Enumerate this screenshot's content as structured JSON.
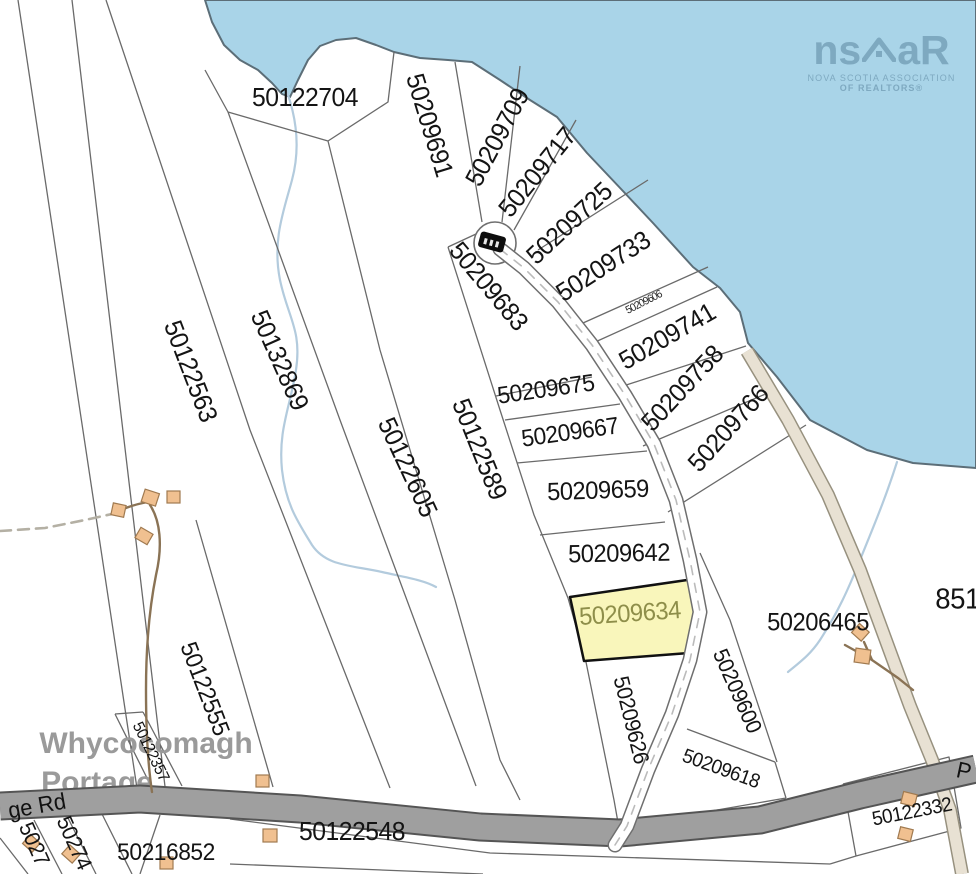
{
  "title": "Whycocomagh Portage parcel map",
  "logo": {
    "left": "ns",
    "right": "aR",
    "tagline1": "NOVA SCOTIA ASSOCIATION",
    "tagline2": "OF REALTORS®"
  },
  "place": {
    "line1": "Whycocomagh",
    "line2": "Portage"
  },
  "highlighted_parcel": {
    "id": "50209634"
  },
  "colors": {
    "water": "#a9d4e8",
    "shoreline": "#5c6e78",
    "parcel_line": "#6a6a6a",
    "highlight_fill": "#f9f6bb",
    "highlight_stroke": "#111111",
    "highlight_label": "#8e8e4a",
    "road_major_fill": "#9f9f9f",
    "road_minor_fill": "#ffffff",
    "highway_fill": "#e8e1d3",
    "building_fill": "#f0c090",
    "stream": "#b3cbdd",
    "logo_color": "#7ea9c0",
    "place_color": "#9a9a9a"
  },
  "labels": [
    {
      "text": "50122704",
      "x": 305,
      "y": 97,
      "rot": 0,
      "size": 26
    },
    {
      "text": "50209691",
      "x": 430,
      "y": 125,
      "rot": 73,
      "size": 26
    },
    {
      "text": "50209709",
      "x": 497,
      "y": 137,
      "rot": -62,
      "size": 26
    },
    {
      "text": "50209717",
      "x": 537,
      "y": 172,
      "rot": -51,
      "size": 26
    },
    {
      "text": "50209725",
      "x": 569,
      "y": 223,
      "rot": -43,
      "size": 26
    },
    {
      "text": "50209733",
      "x": 603,
      "y": 266,
      "rot": -33,
      "size": 26
    },
    {
      "text": "50209606",
      "x": 644,
      "y": 303,
      "rot": -27,
      "size": 11,
      "kind": "tiny"
    },
    {
      "text": "50209741",
      "x": 667,
      "y": 336,
      "rot": -30,
      "size": 26
    },
    {
      "text": "50209758",
      "x": 682,
      "y": 388,
      "rot": -47,
      "size": 26
    },
    {
      "text": "50209766",
      "x": 728,
      "y": 428,
      "rot": -48,
      "size": 26
    },
    {
      "text": "50209683",
      "x": 489,
      "y": 286,
      "rot": 50,
      "size": 26
    },
    {
      "text": "50122563",
      "x": 191,
      "y": 371,
      "rot": 69,
      "size": 26
    },
    {
      "text": "50132869",
      "x": 280,
      "y": 360,
      "rot": 66,
      "size": 26
    },
    {
      "text": "50122605",
      "x": 408,
      "y": 467,
      "rot": 65,
      "size": 26
    },
    {
      "text": "50122589",
      "x": 480,
      "y": 449,
      "rot": 68,
      "size": 26
    },
    {
      "text": "50209675",
      "x": 546,
      "y": 390,
      "rot": -8,
      "size": 24
    },
    {
      "text": "50209667",
      "x": 570,
      "y": 433,
      "rot": -8,
      "size": 24
    },
    {
      "text": "50209659",
      "x": 598,
      "y": 491,
      "rot": -2,
      "size": 25
    },
    {
      "text": "50209642",
      "x": 619,
      "y": 554,
      "rot": -1,
      "size": 25
    },
    {
      "text": "50209634",
      "x": 630,
      "y": 614,
      "rot": -4,
      "size": 25,
      "kind": "highlight"
    },
    {
      "text": "50209626",
      "x": 631,
      "y": 720,
      "rot": 76,
      "size": 22
    },
    {
      "text": "50209600",
      "x": 737,
      "y": 691,
      "rot": 66,
      "size": 22
    },
    {
      "text": "50209618",
      "x": 721,
      "y": 769,
      "rot": 20,
      "size": 20
    },
    {
      "text": "50206465",
      "x": 818,
      "y": 623,
      "rot": 0,
      "size": 25
    },
    {
      "text": "8510",
      "x": 965,
      "y": 600,
      "rot": 0,
      "size": 29,
      "kind": "partial"
    },
    {
      "text": "50122332",
      "x": 912,
      "y": 812,
      "rot": -11,
      "size": 20
    },
    {
      "text": "50122555",
      "x": 204,
      "y": 689,
      "rot": 69,
      "size": 24
    },
    {
      "text": "50122357",
      "x": 150,
      "y": 752,
      "rot": 64,
      "size": 16
    },
    {
      "text": "5027",
      "x": 34,
      "y": 844,
      "rot": 66,
      "size": 22,
      "kind": "partial"
    },
    {
      "text": "50274",
      "x": 74,
      "y": 843,
      "rot": 66,
      "size": 22,
      "kind": "partial"
    },
    {
      "text": "50216852",
      "x": 166,
      "y": 853,
      "rot": 0,
      "size": 24
    },
    {
      "text": "50122548",
      "x": 352,
      "y": 831,
      "rot": 0,
      "size": 26
    },
    {
      "text": "ge Rd",
      "x": 37,
      "y": 806,
      "rot": -10,
      "size": 23,
      "kind": "road"
    },
    {
      "text": "P",
      "x": 964,
      "y": 771,
      "rot": 12,
      "size": 23,
      "kind": "road"
    }
  ]
}
